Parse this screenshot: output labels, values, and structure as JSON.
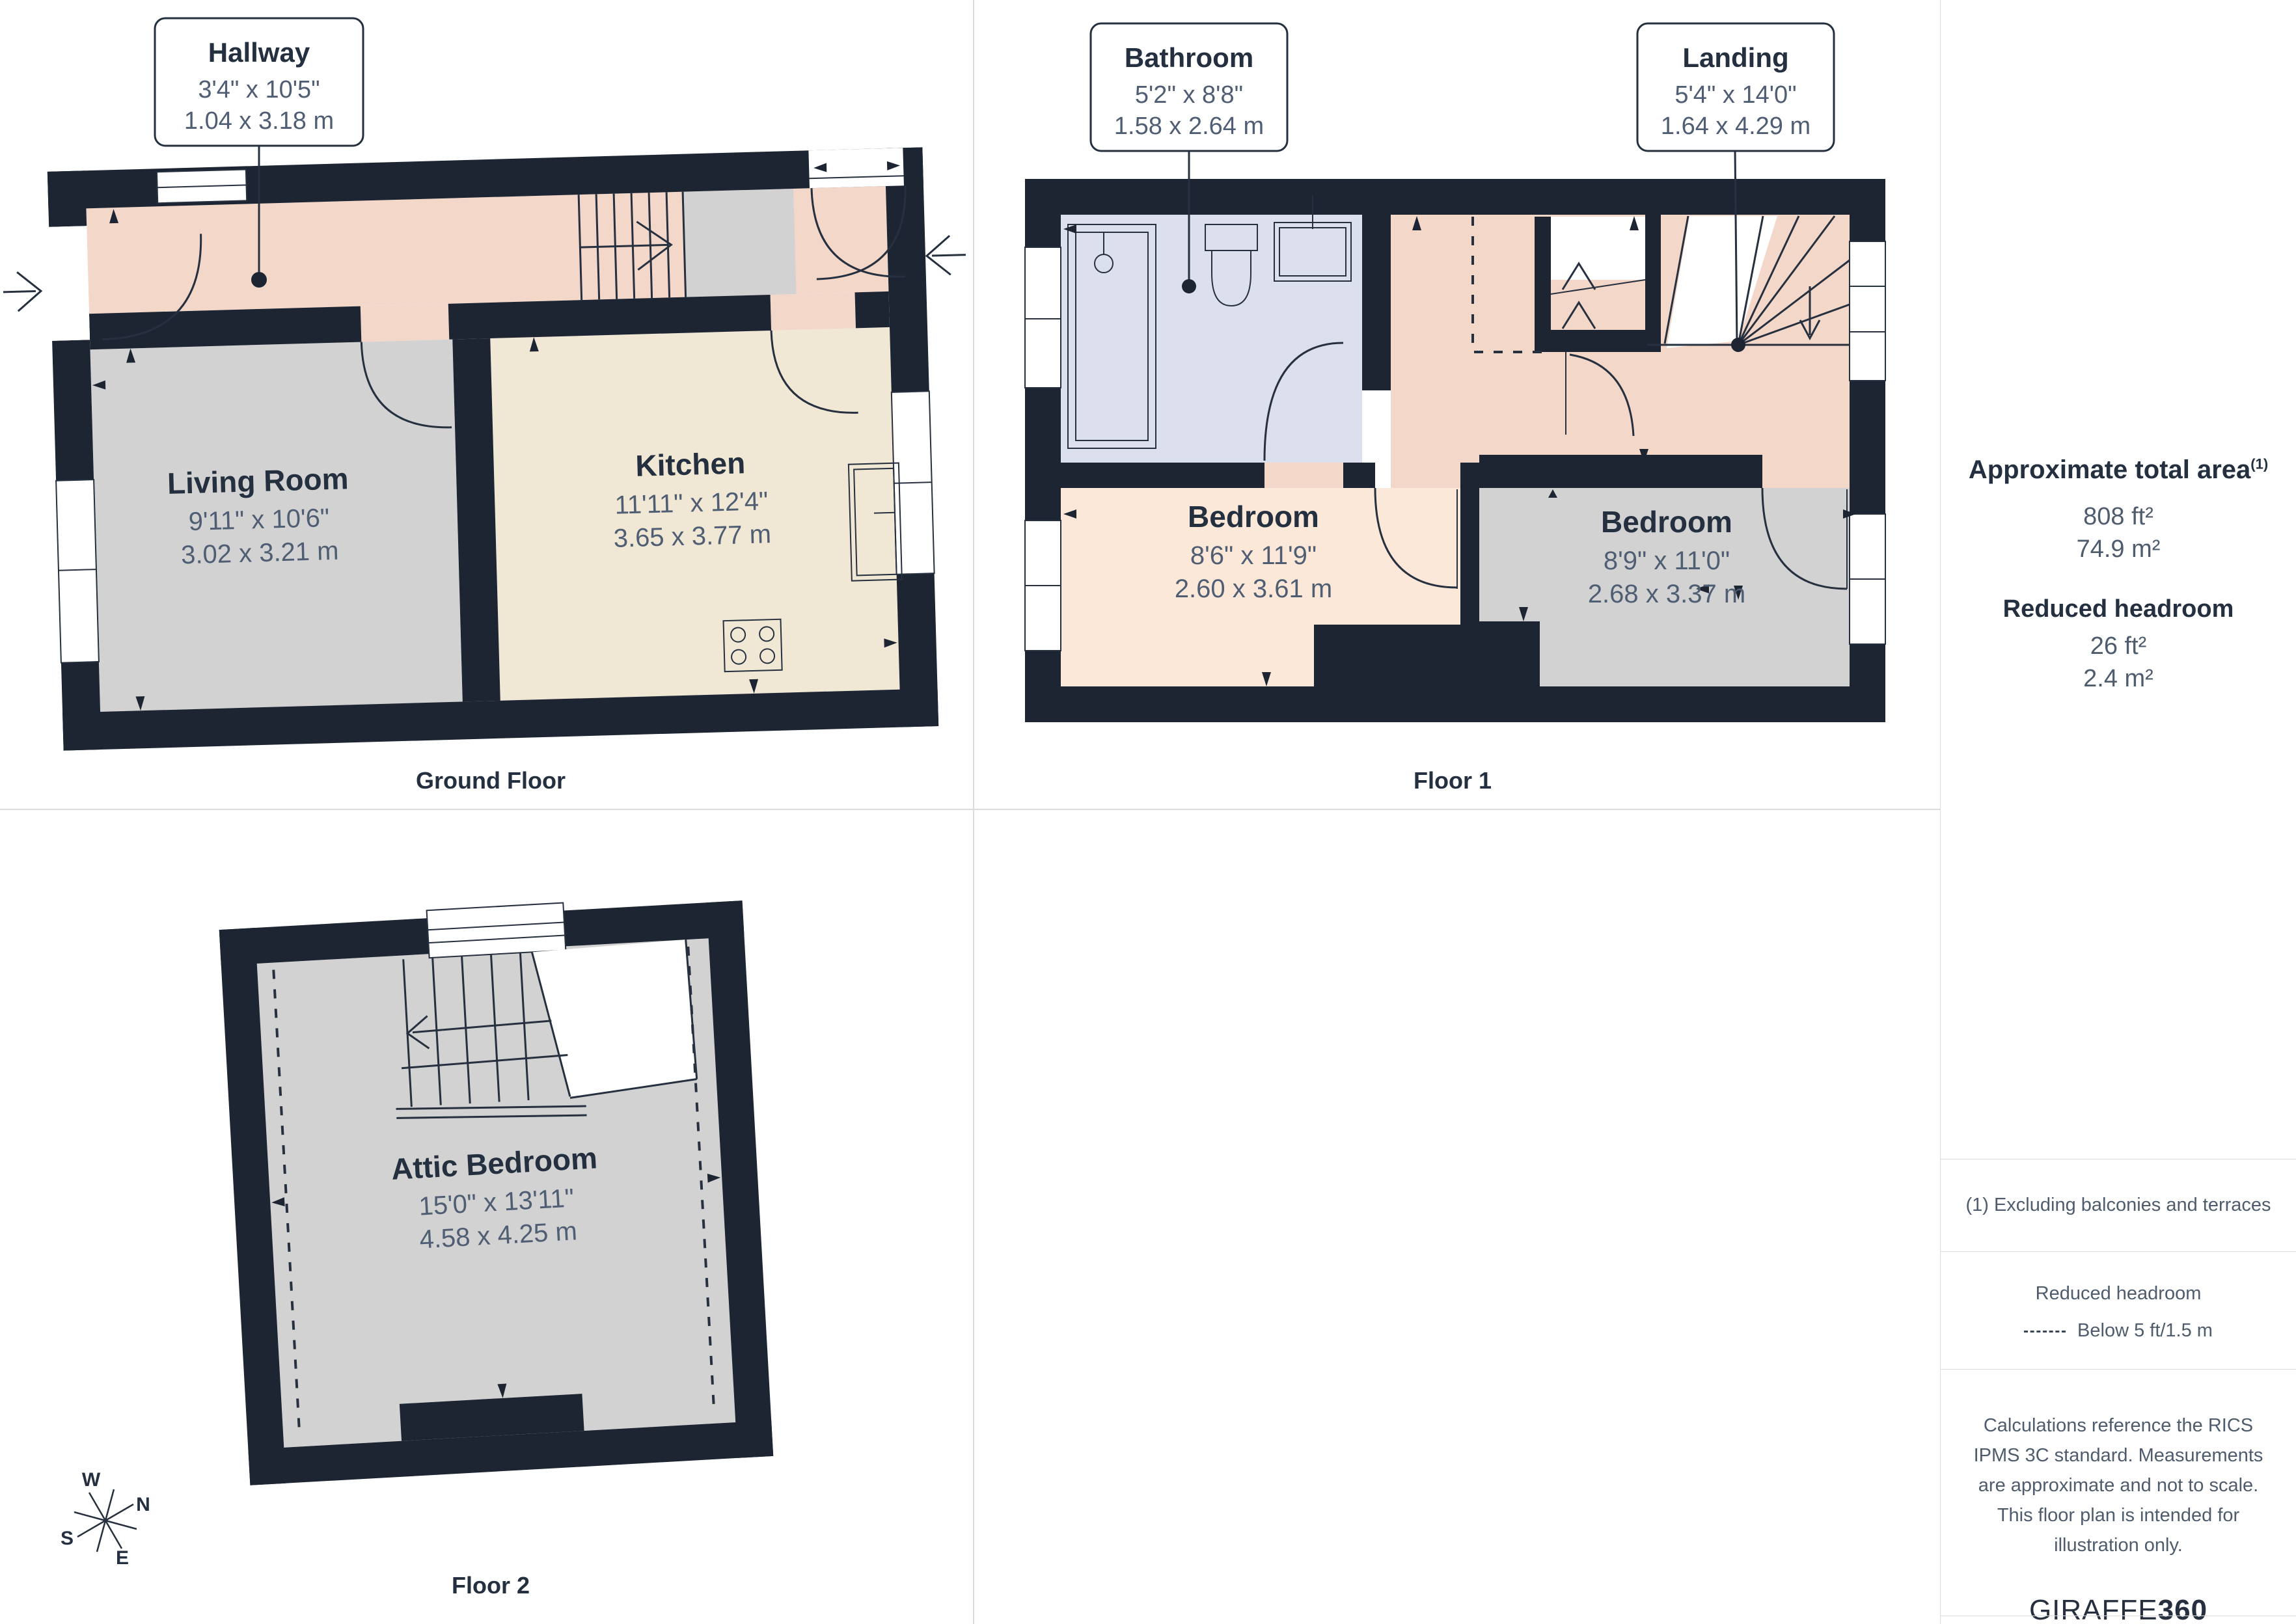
{
  "colors": {
    "wall": "#1d2533",
    "hallway_landing": "#f3d7c9",
    "gray_room": "#d2d2d2",
    "kitchen": "#f0e8d5",
    "bathroom": "#dbe0ec",
    "front_bedroom": "#fce8d8",
    "text_dark": "#24303f",
    "text_dim": "#505e74",
    "grid_line": "#dcdcdc"
  },
  "ground_floor": {
    "caption": "Ground Floor",
    "hallway": {
      "name": "Hallway",
      "imperial": "3'4\" x 10'5\"",
      "metric": "1.04 x 3.18 m"
    },
    "living_room": {
      "name": "Living Room",
      "imperial": "9'11\" x 10'6\"",
      "metric": "3.02 x 3.21 m"
    },
    "kitchen": {
      "name": "Kitchen",
      "imperial": "11'11\" x 12'4\"",
      "metric": "3.65 x 3.77 m"
    }
  },
  "floor1": {
    "caption": "Floor 1",
    "bathroom": {
      "name": "Bathroom",
      "imperial": "5'2\" x 8'8\"",
      "metric": "1.58 x 2.64 m"
    },
    "landing": {
      "name": "Landing",
      "imperial": "5'4\" x 14'0\"",
      "metric": "1.64 x 4.29 m"
    },
    "bedroom_front": {
      "name": "Bedroom",
      "imperial": "8'6\" x 11'9\"",
      "metric": "2.60 x 3.61 m"
    },
    "bedroom_back": {
      "name": "Bedroom",
      "imperial": "8'9\" x 11'0\"",
      "metric": "2.68 x 3.37 m"
    }
  },
  "floor2": {
    "caption": "Floor 2",
    "attic_bedroom": {
      "name": "Attic Bedroom",
      "imperial": "15'0\" x 13'11\"",
      "metric": "4.58 x 4.25 m"
    }
  },
  "compass": {
    "n": "N",
    "e": "E",
    "s": "S",
    "w": "W"
  },
  "sidebar": {
    "total_area_label": "Approximate total area",
    "total_area_footnote_mark": "(1)",
    "total_area_ft": "808 ft²",
    "total_area_m": "74.9 m²",
    "reduced_headroom_label": "Reduced headroom",
    "reduced_headroom_ft": "26 ft²",
    "reduced_headroom_m": "2.4 m²",
    "footnote": "(1) Excluding balconies and terraces",
    "legend_title": "Reduced headroom",
    "legend_item": "Below 5 ft/1.5 m",
    "disclaimer": "Calculations reference the RICS IPMS 3C standard. Measurements are approximate and not to scale. This floor plan is intended for illustration only.",
    "brand_primary": "GIRAFFE",
    "brand_secondary": "360"
  }
}
